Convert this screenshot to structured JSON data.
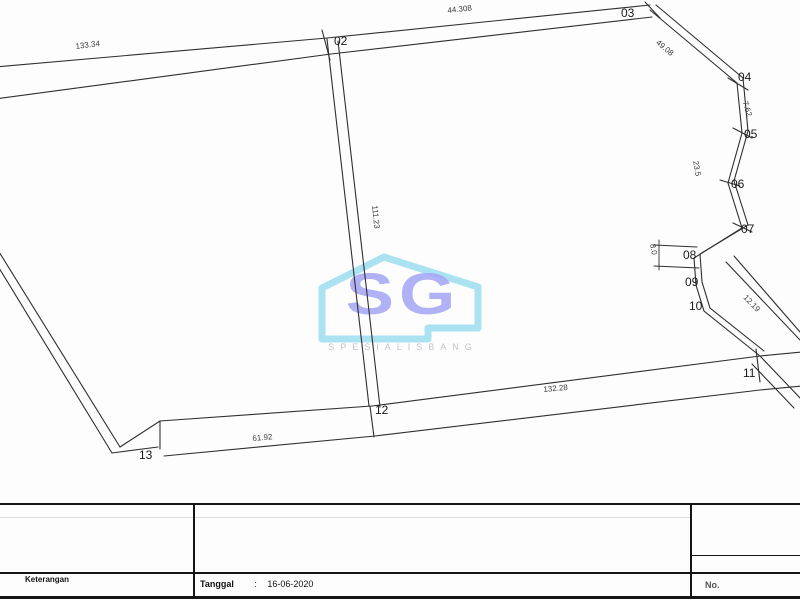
{
  "watermark": {
    "monogram": "SG",
    "subtitle": "SPESIALISBANG",
    "outline_color": "#7ed3ec",
    "monogram_color": "#8d8df2",
    "subtitle_color": "#aeaeb8"
  },
  "drawing": {
    "points": [
      {
        "label": "02",
        "x": 334,
        "y": 34
      },
      {
        "label": "03",
        "x": 621,
        "y": 6
      },
      {
        "label": "04",
        "x": 738,
        "y": 70
      },
      {
        "label": "05",
        "x": 744,
        "y": 127
      },
      {
        "label": "06",
        "x": 731,
        "y": 177
      },
      {
        "label": "07",
        "x": 741,
        "y": 222
      },
      {
        "label": "08",
        "x": 683,
        "y": 248
      },
      {
        "label": "09",
        "x": 685,
        "y": 275
      },
      {
        "label": "10",
        "x": 689,
        "y": 299
      },
      {
        "label": "11",
        "x": 743,
        "y": 366
      },
      {
        "label": "12",
        "x": 375,
        "y": 403
      },
      {
        "label": "13",
        "x": 139,
        "y": 448
      }
    ],
    "dimensions": [
      {
        "text": "133.34",
        "x": 75,
        "y": 42,
        "rot": -7
      },
      {
        "text": "44.308",
        "x": 447,
        "y": 6,
        "rot": -6
      },
      {
        "text": "49.08",
        "x": 660,
        "y": 38,
        "rot": 40
      },
      {
        "text": "7.62",
        "x": 749,
        "y": 100,
        "rot": 72
      },
      {
        "text": "23.5",
        "x": 700,
        "y": 160,
        "rot": 80
      },
      {
        "text": "8.0",
        "x": 657,
        "y": 243,
        "rot": 80
      },
      {
        "text": "12.19",
        "x": 748,
        "y": 293,
        "rot": 46
      },
      {
        "text": "111.23",
        "x": 379,
        "y": 205,
        "rot": 84
      },
      {
        "text": "61.92",
        "x": 252,
        "y": 434,
        "rot": -5
      },
      {
        "text": "132.28",
        "x": 543,
        "y": 385,
        "rot": -5
      }
    ]
  },
  "titleblock": {
    "left_label": "Keterangan",
    "date_label": "Tanggal",
    "date_separator": ":",
    "date_value": "16-06-2020",
    "right_label": "No."
  }
}
